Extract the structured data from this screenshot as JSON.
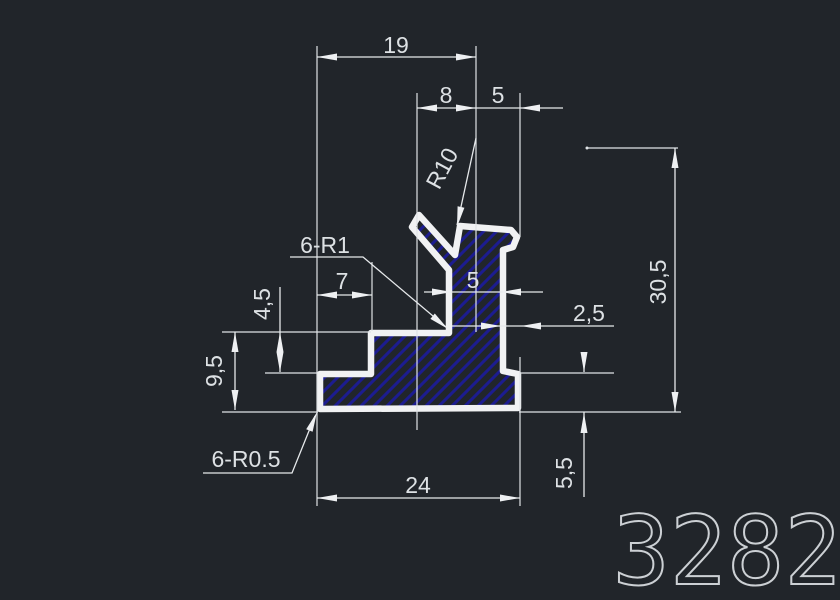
{
  "drawing": {
    "part_number": "3282",
    "labels": {
      "top_width": "19",
      "slot_offset": "8",
      "slot_width": "5",
      "top_radius": "R10",
      "fillet_note": "6-R1",
      "step_width": "7",
      "stem_width": "5",
      "step_height": "4,5",
      "left_height": "9,5",
      "lip_width": "2,5",
      "overall_height": "30,5",
      "foot_height": "5,5",
      "base_width": "24",
      "corner_fillet_note": "6-R0.5"
    },
    "colors": {
      "background": "#21252a",
      "outline": "#f1f2f3",
      "hatch": "#1c1c90",
      "dimension": "#dde1e4"
    }
  }
}
